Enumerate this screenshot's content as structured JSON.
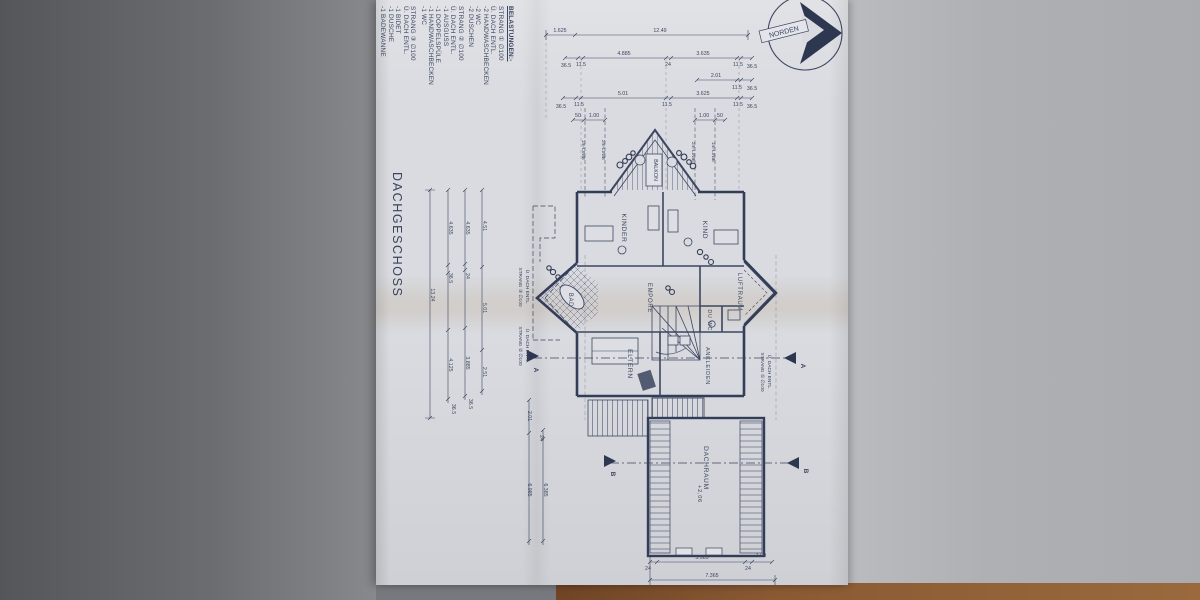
{
  "photo": {
    "surface_left_color": "#6a6c70",
    "surface_right_color": "#aeb0b4",
    "table_color": "#8a5a33",
    "paper_color": "#d9dbe0",
    "ink_color": "#3c4660"
  },
  "title_block": {
    "title": "DACHGESCHOSS"
  },
  "compass": {
    "label": "NORDEN"
  },
  "legend": {
    "title": "BELASTUNGEN:-",
    "strands": [
      {
        "heading": "STRANG ① ∅100",
        "lines": [
          "Ü. DACH ENTL.",
          "-2 HANDWASCHBECKEN",
          "-2 WC",
          "-2 DUSCHEN"
        ]
      },
      {
        "heading": "STRANG ② ∅100",
        "lines": [
          "Ü. DACH ENTL.",
          "-1 AUSGUSS",
          "-1 DOPPELSPÜLE",
          "-1 HANDWASCHBECKEN",
          "-1 WC"
        ]
      },
      {
        "heading": "STRANG ③ ∅100",
        "lines": [
          "Ü. DACH ENTL.",
          "-1 BIDET",
          "-1 DUSCHE",
          "-1 BADEWANNE"
        ]
      }
    ]
  },
  "rooms": {
    "kinder": "KINDER",
    "kind": "KIND",
    "balkon": "BALKON",
    "bad": "BAD",
    "empore": "EMPORE",
    "luftraum": "LUFTRAUM",
    "du": "DU",
    "wc": "WC",
    "eltern": "ELTERN",
    "ankleiden": "ANKLEIDEN",
    "dachraum": "DACHRAUM"
  },
  "annotations": {
    "dachraum_level": "+2,06",
    "strand1_callout": [
      "STRANG ① ∅100",
      "Ü. DACH ENTL."
    ],
    "strand2_callout": [
      "STRANG ② ∅100",
      "Ü. DACH ENTL."
    ],
    "strand3_callout": [
      "STRANG ③ ∅100",
      "Ü. DACH ENTL."
    ],
    "roof_lines": [
      "1m-LINIE",
      "2m-LINIE",
      "2m-LINIE",
      "1m-LINIE"
    ],
    "section_a": "A",
    "section_b": "B"
  },
  "dimensions": {
    "top_row1": [
      "1.625",
      "12.49"
    ],
    "top_row2": [
      "36.5",
      "11.5",
      "4.885",
      "24",
      "3.635",
      "11.5",
      "36.5"
    ],
    "top_row3": [
      "2.01",
      "11.5",
      "36.5"
    ],
    "top_row4": [
      "36.5",
      "11.5",
      "5.01",
      "11.5",
      "3.625",
      "11.5",
      "36.5"
    ],
    "top_row5_left": [
      "50",
      "1.00"
    ],
    "top_row5_right": [
      "1.00",
      "50"
    ],
    "left_chain1": [
      "13.24"
    ],
    "left_chain2": [
      "4.635",
      "36.5",
      "4.125",
      "36.5"
    ],
    "left_chain3": [
      "4.635",
      "24",
      "3.885",
      "36.5"
    ],
    "left_chain4": [
      "4.51",
      "5.01",
      "2.51"
    ],
    "left_mid": [
      "2.01",
      "24",
      "6.985",
      "6.385"
    ],
    "bottom_row1": [
      "24",
      "5.985",
      "24",
      "1.00"
    ],
    "bottom_row2": [
      "7.365"
    ]
  }
}
